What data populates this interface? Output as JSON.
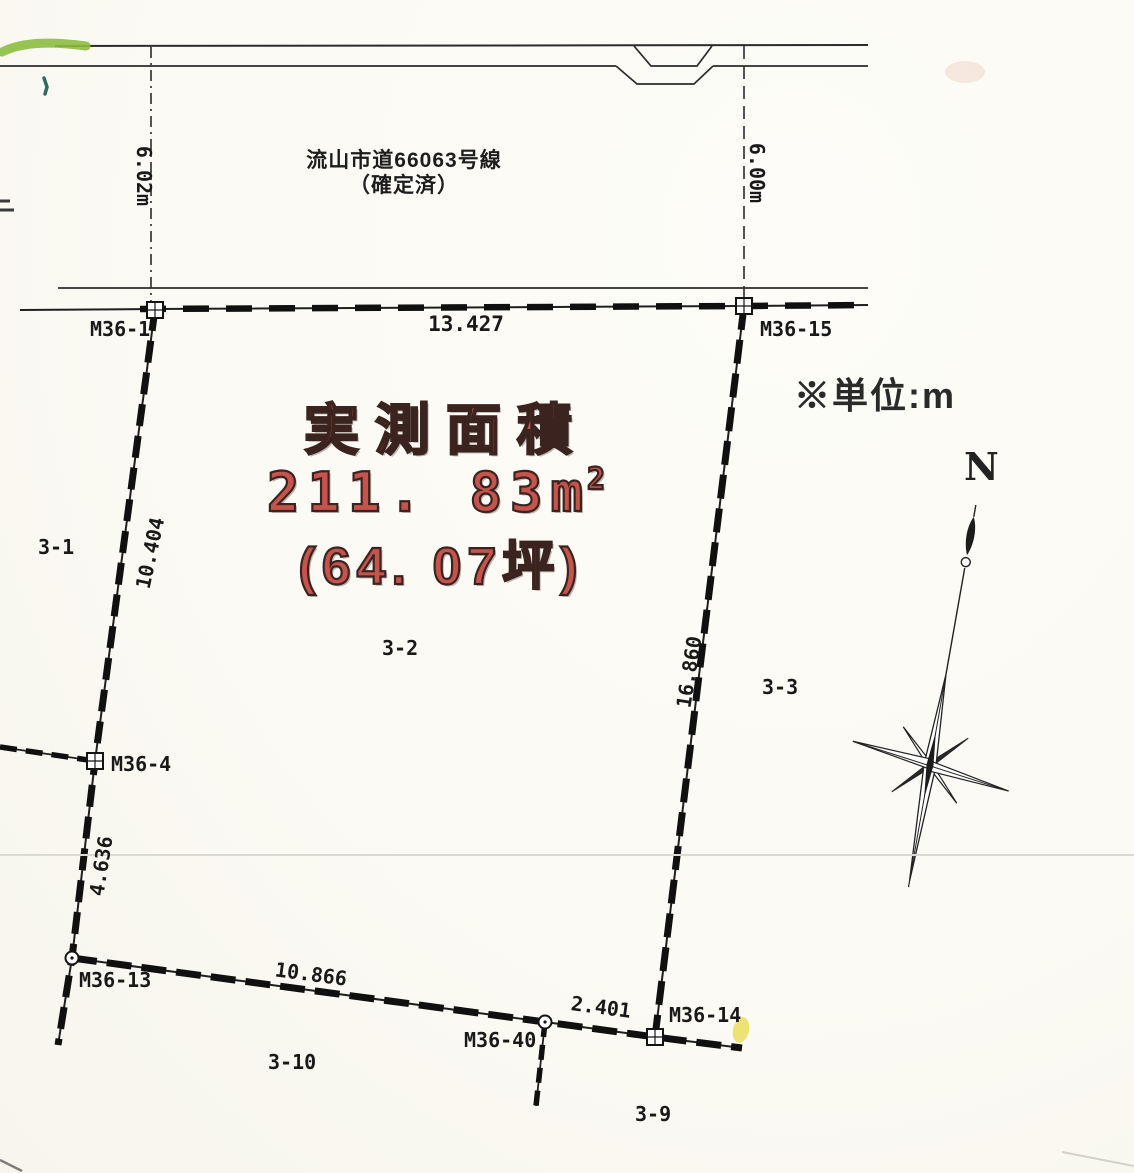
{
  "road": {
    "name_line1": "流山市道66063号線",
    "name_line2": "（確定済）",
    "width_left": "6.02m",
    "width_right": "6.00m"
  },
  "note": {
    "unit": "※単位:m"
  },
  "compass": {
    "north": "N"
  },
  "area": {
    "title": "実測面積",
    "value_main": "211. 83m",
    "value_sup": "2",
    "value_tsubo": "(64. 07坪)"
  },
  "dims": {
    "top": "13.427",
    "left_upper": "10.404",
    "left_lower": "4.636",
    "right_side": "16.860",
    "bottom": "10.866",
    "bottom_right": "2.401"
  },
  "markers": {
    "m1": "M36-1",
    "m15": "M36-15",
    "m4": "M36-4",
    "m13": "M36-13",
    "m40": "M36-40",
    "m14": "M36-14"
  },
  "parcels": {
    "p31": "3-1",
    "p32": "3-2",
    "p33": "3-3",
    "p310": "3-10",
    "p39": "3-9"
  },
  "colors": {
    "ink": "#1a1a1a",
    "red_fill": "#c5544c",
    "red_outline": "#3b241f",
    "paper": "#fbfaf4",
    "highlight_green": "#8cbd40",
    "highlight_yellow": "#ead94e"
  }
}
